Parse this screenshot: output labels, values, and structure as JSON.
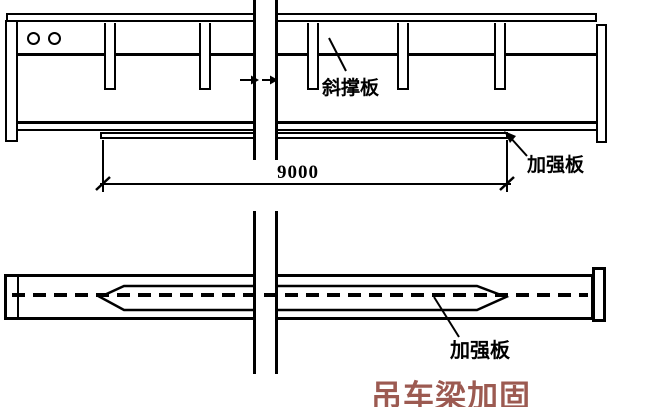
{
  "diagram": {
    "title": "吊车梁加固",
    "title_color": "#9c5a51",
    "colors": {
      "line": "#000000",
      "background": "#ffffff"
    },
    "elevation": {
      "brace_plate_label": "斜撑板",
      "reinforcement_plate_label": "加强板",
      "dimension": "9000"
    },
    "plan": {
      "reinforcement_plate_label": "加强板"
    }
  }
}
